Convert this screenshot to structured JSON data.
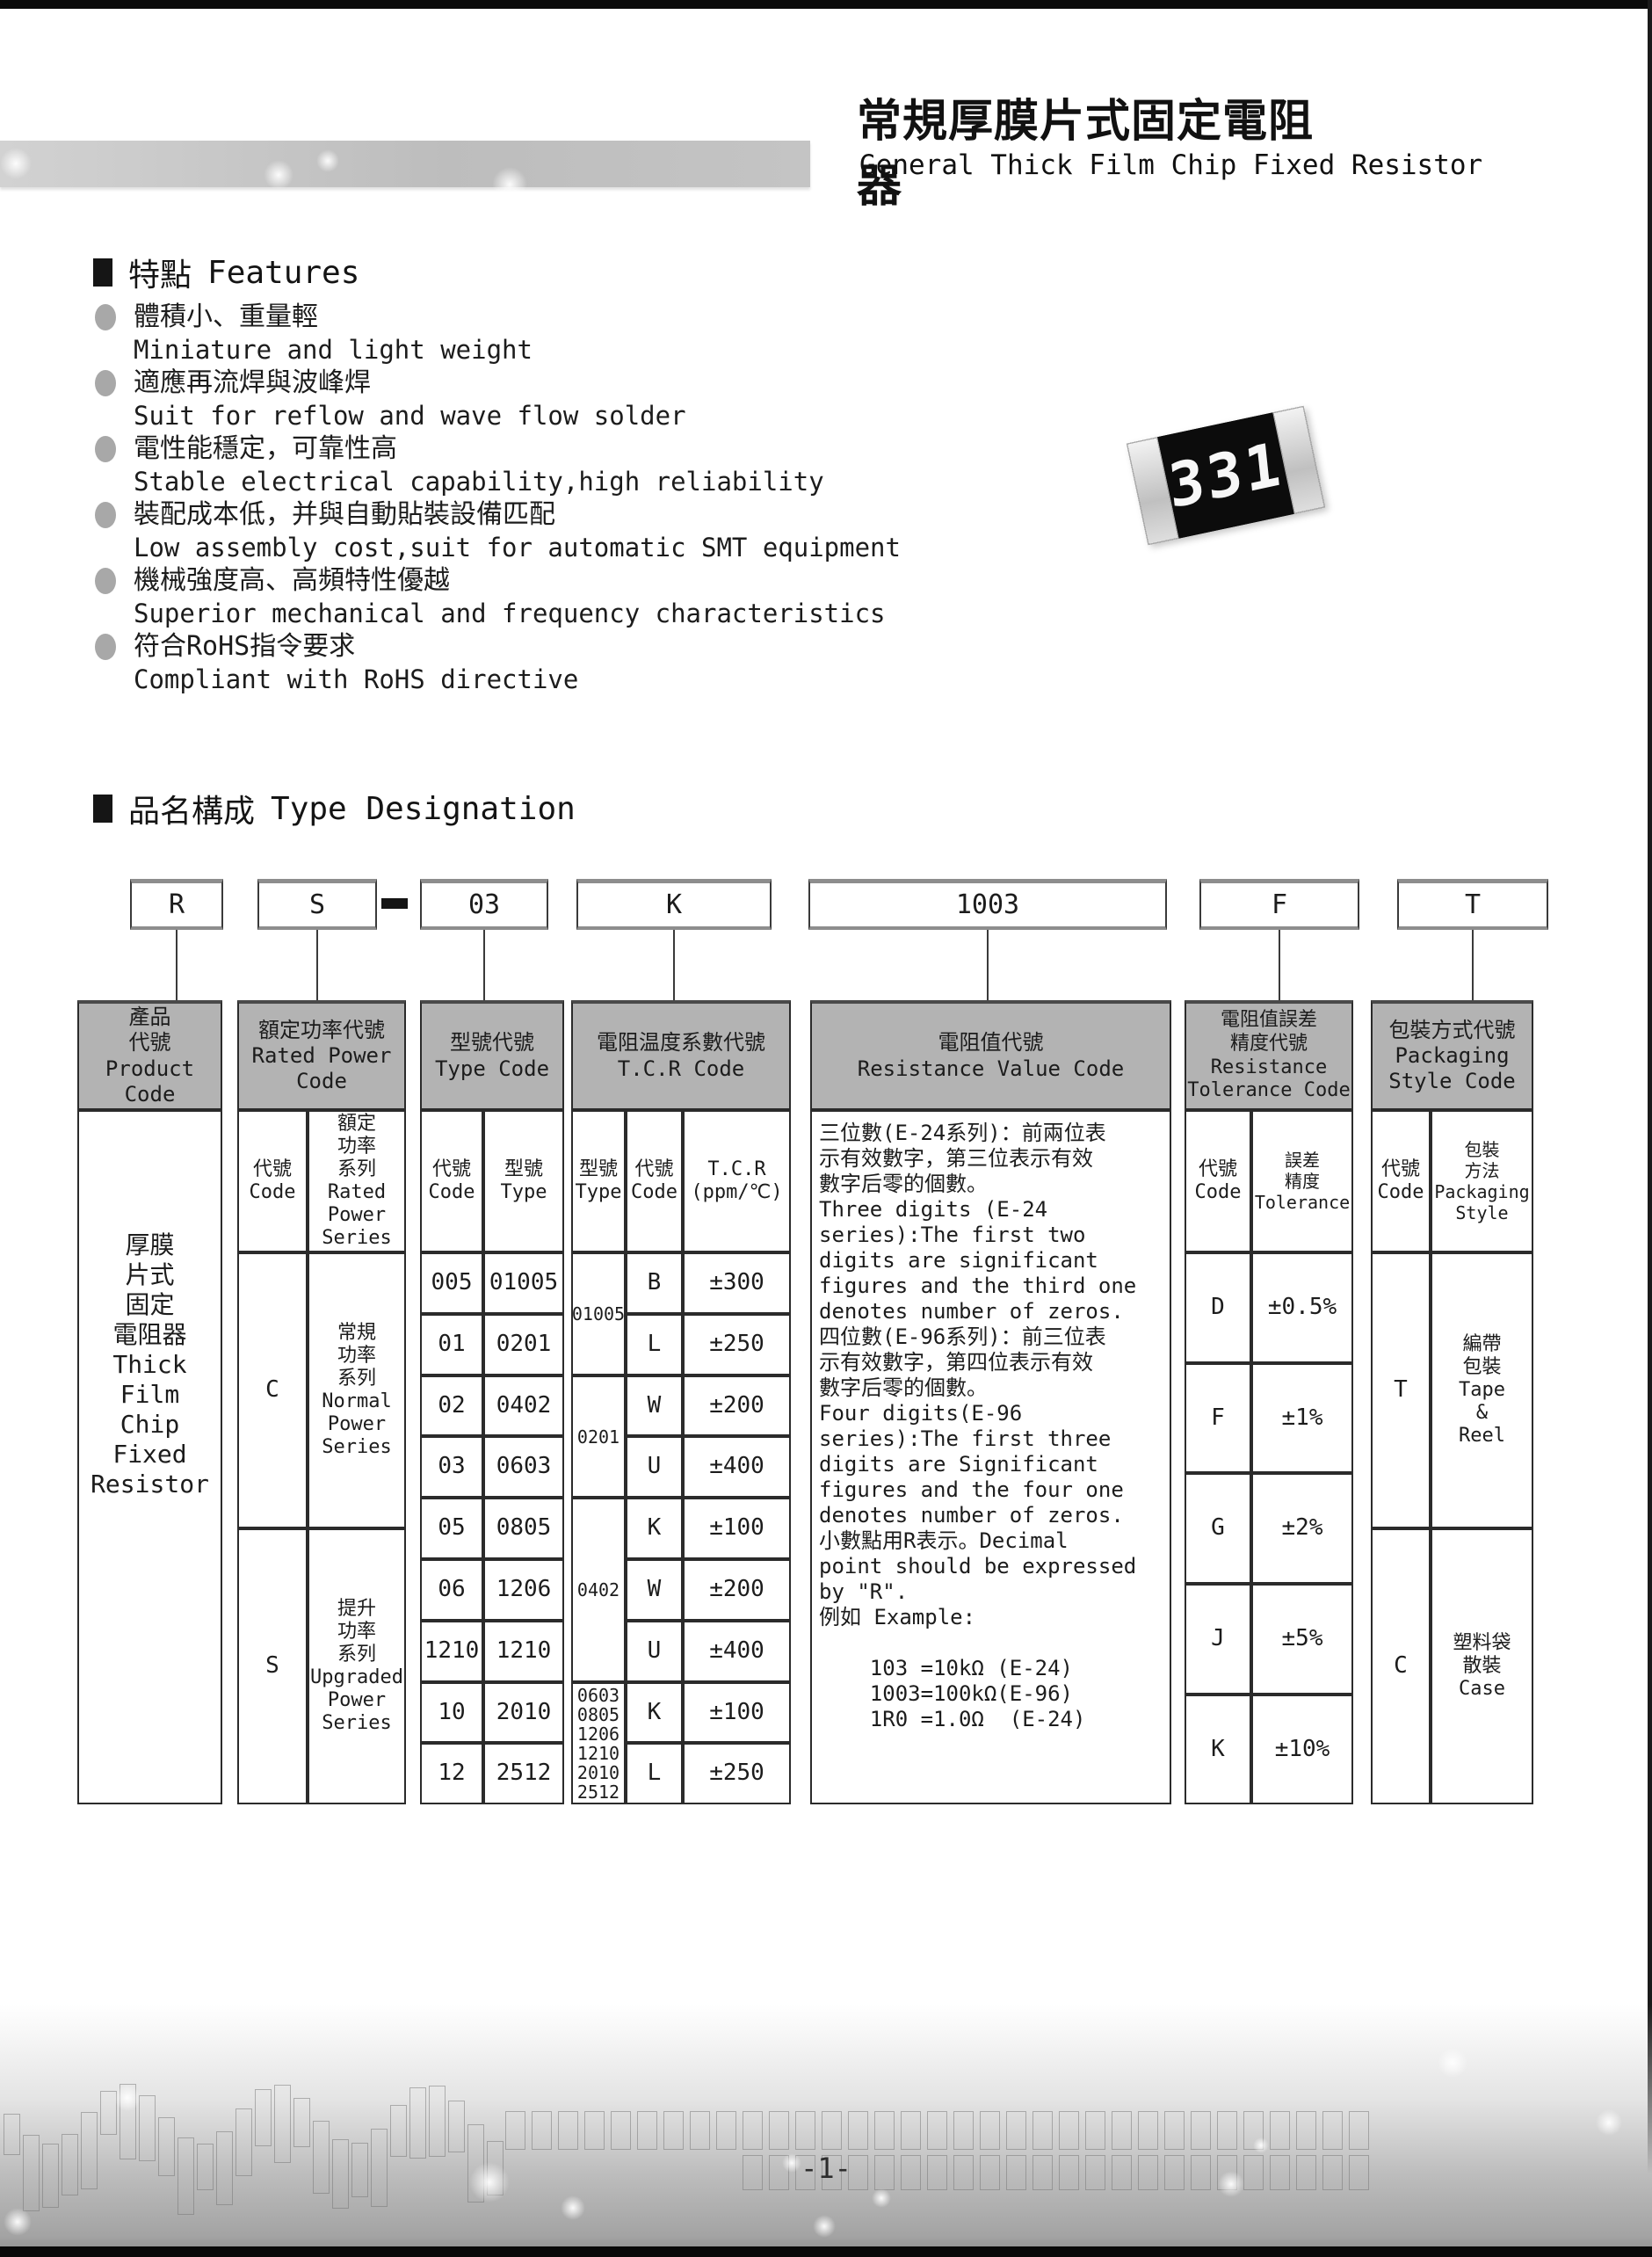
{
  "colors": {
    "table_header_bg": "#b3b3b3",
    "page_edge": "#0a0a0a",
    "band_gray": "#c6c6c6"
  },
  "header": {
    "title_zh": "常規厚膜片式固定電阻器",
    "title_en": "General Thick Film Chip Fixed Resistor"
  },
  "resistor_image": {
    "marking": "331"
  },
  "features": {
    "heading_zh": "特點",
    "heading_en": "Features",
    "items": [
      {
        "zh": "體積小、重量輕",
        "en": "Miniature and light weight"
      },
      {
        "zh": "適應再流焊與波峰焊",
        "en": "Suit for reflow and wave flow solder"
      },
      {
        "zh": "電性能穩定，可靠性高",
        "en": "Stable electrical capability,high reliability"
      },
      {
        "zh": "裝配成本低，并與自動貼裝設備匹配",
        "en": "Low assembly cost,suit for automatic SMT equipment"
      },
      {
        "zh": "機械強度高、高頻特性優越",
        "en": "Superior mechanical and frequency characteristics"
      },
      {
        "zh": "符合RoHS指令要求",
        "en": "Compliant with RoHS directive"
      }
    ]
  },
  "type_designation": {
    "heading_zh": "品名構成",
    "heading_en": "Type Designation",
    "boxes": {
      "b0": "R",
      "b1": "S",
      "b2": "03",
      "b3": "K",
      "b4": "1003",
      "b5": "F",
      "b6": "T"
    }
  },
  "table": {
    "product": {
      "header": "產品\n代號\nProduct\nCode",
      "body": "厚膜\n片式\n固定\n電阻器\nThick\nFilm\nChip\nFixed\nResistor"
    },
    "rated_power": {
      "header": "額定功率代號\nRated Power\nCode",
      "sub_code": "代號\nCode",
      "sub_series": "額定\n功率\n系列\nRated\nPower\nSeries",
      "rows": [
        {
          "code": "C",
          "series": "常規\n功率\n系列\nNormal\nPower\nSeries"
        },
        {
          "code": "S",
          "series": "提升\n功率\n系列\nUpgraded\nPower\nSeries"
        }
      ]
    },
    "type_code": {
      "header": "型號代號\nType Code",
      "sub_code": "代號\nCode",
      "sub_type": "型號\nType",
      "rows": [
        {
          "code": "005",
          "type": "01005"
        },
        {
          "code": "01",
          "type": "0201"
        },
        {
          "code": "02",
          "type": "0402"
        },
        {
          "code": "03",
          "type": "0603"
        },
        {
          "code": "05",
          "type": "0805"
        },
        {
          "code": "06",
          "type": "1206"
        },
        {
          "code": "1210",
          "type": "1210"
        },
        {
          "code": "10",
          "type": "2010"
        },
        {
          "code": "12",
          "type": "2512"
        }
      ]
    },
    "tcr": {
      "header": "電阻温度系數代號\nT.C.R Code",
      "sub_type": "型號\nType",
      "sub_code": "代號\nCode",
      "sub_value": "T.C.R\n(ppm/℃)",
      "groups": [
        {
          "type": "01005",
          "rows": [
            {
              "code": "B",
              "value": "±300"
            },
            {
              "code": "L",
              "value": "±250"
            }
          ]
        },
        {
          "type": "0201",
          "rows": [
            {
              "code": "W",
              "value": "±200"
            },
            {
              "code": "U",
              "value": "±400"
            }
          ]
        },
        {
          "type": "0402",
          "rows": [
            {
              "code": "K",
              "value": "±100"
            },
            {
              "code": "W",
              "value": "±200"
            },
            {
              "code": "U",
              "value": "±400"
            }
          ]
        },
        {
          "type": "0603\n0805\n1206\n1210\n2010\n2512",
          "rows": [
            {
              "code": "K",
              "value": "±100"
            },
            {
              "code": "L",
              "value": "±250"
            }
          ]
        }
      ]
    },
    "resistance_value": {
      "header": "電阻值代號\nResistance Value Code",
      "body": "三位數(E-24系列)：前兩位表\n示有效數字，第三位表示有效\n數字后零的個數。\nThree digits (E-24\nseries):The first two\ndigits are significant\nfigures and the third one\ndenotes number of zeros.\n四位數(E-96系列)：前三位表\n示有效數字，第四位表示有效\n數字后零的個數。\nFour digits(E-96\nseries):The first three\ndigits are Significant\nfigures and the four one\ndenotes number of zeros.\n小數點用R表示。Decimal\npoint should be expressed\nby \"R\".\n例如 Example:\n\n    103 =10kΩ (E-24)\n    1003=100kΩ(E-96)\n    1R0 =1.0Ω  (E-24)"
    },
    "tolerance": {
      "header": "電阻值誤差\n精度代號\nResistance\nTolerance Code",
      "sub_code": "代號\nCode",
      "sub_value": "誤差\n精度\nTolerance",
      "rows": [
        {
          "code": "D",
          "value": "±0.5%"
        },
        {
          "code": "F",
          "value": "±1%"
        },
        {
          "code": "G",
          "value": "±2%"
        },
        {
          "code": "J",
          "value": "±5%"
        },
        {
          "code": "K",
          "value": "±10%"
        }
      ]
    },
    "packaging": {
      "header": "包裝方式代號\nPackaging\nStyle Code",
      "sub_code": "代號\nCode",
      "sub_style": "包裝\n方法\nPackaging\nStyle",
      "rows": [
        {
          "code": "T",
          "style": "編帶\n包裝\nTape\n&\nReel"
        },
        {
          "code": "C",
          "style": "塑料袋\n散裝\nCase"
        }
      ]
    }
  },
  "footer": {
    "page_number": "-1-"
  }
}
